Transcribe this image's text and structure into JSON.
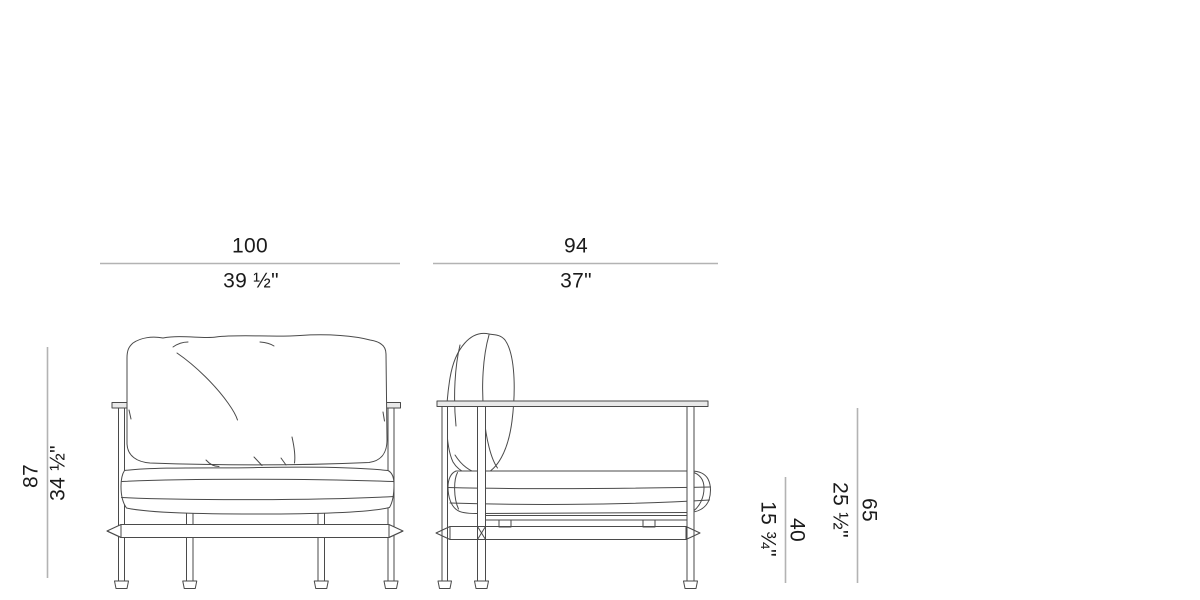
{
  "diagram": {
    "type": "furniture-dimension-drawing",
    "subject": "armchair front and side elevation",
    "views": [
      "front",
      "side"
    ]
  },
  "dimensions": {
    "width": {
      "cm": "100",
      "inches": "39 ½\""
    },
    "depth": {
      "cm": "94",
      "inches": "37\""
    },
    "height": {
      "cm": "87",
      "inches": "34 ½\""
    },
    "arm_height": {
      "cm": "65",
      "inches": "25 ½\""
    },
    "seat_height": {
      "cm": "40",
      "inches": "15 ¾\""
    }
  },
  "colors": {
    "background": "#ffffff",
    "drawing_line": "#4a4a4a",
    "dimension_line": "#b3b3b3",
    "text": "#1b1b1b",
    "frame_fill": "#e9e9e9"
  }
}
